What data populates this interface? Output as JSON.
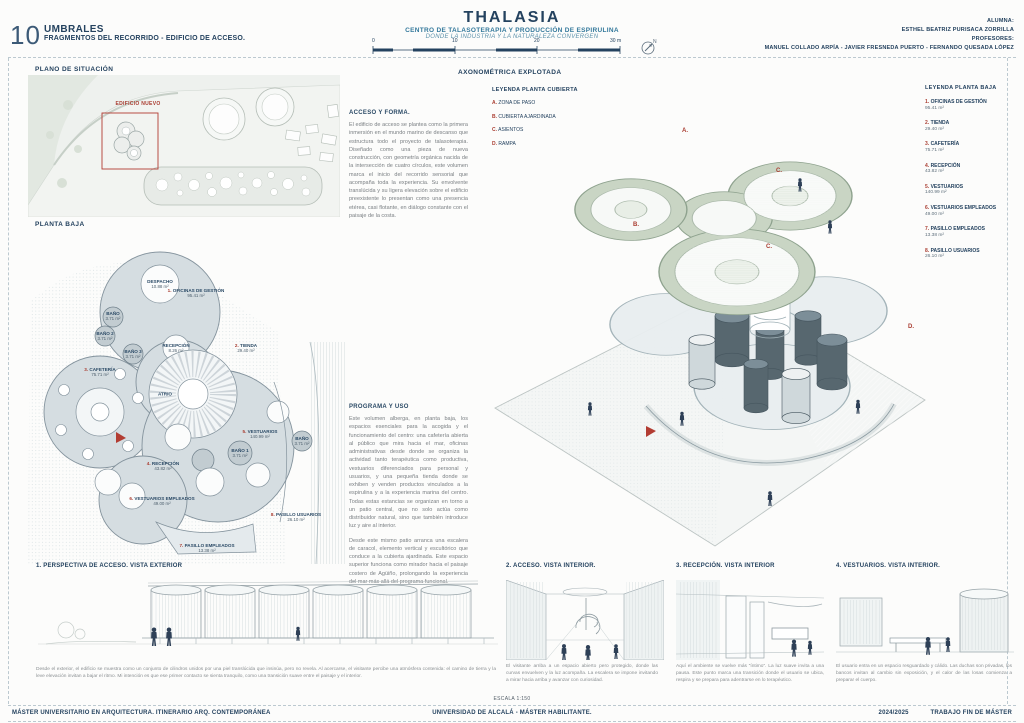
{
  "colors": {
    "navy": "#24425f",
    "red": "#a93c30",
    "teal": "#33789b",
    "roof_green": "#c9d5c4",
    "plan_gray": "#d5dde1"
  },
  "page": {
    "number": "10",
    "series_title": "UMBRALES",
    "series_subtitle": "FRAGMENTOS DEL RECORRIDO - EDIFICIO DE ACCESO.",
    "project_title": "THALASIA",
    "project_subtitle": "CENTRO DE TALASOTERAPIA Y PRODUCCIÓN DE ESPIRULINA",
    "project_tagline": "DONDE LA INDUSTRIA Y LA NATURALEZA CONVERGEN",
    "credits": {
      "alumna_label": "ALUMNA:",
      "alumna": "ESTHEL BEATRIZ PURISACA ZORRILLA",
      "profesores_label": "PROFESORES:",
      "profesores": "MANUEL COLLADO ARPÍA - JAVIER FRESNEDA PUERTO - FERNANDO QUESADA LÓPEZ"
    },
    "scale_bar": {
      "ticks": [
        "0",
        "10",
        "20",
        "30 m"
      ]
    },
    "escala": "ESCALA 1:150",
    "footer": {
      "left": "MÁSTER UNIVERSITARIO EN ARQUITECTURA. ITINERARIO ARQ. CONTEMPORÁNEA",
      "center": "UNIVERSIDAD DE ALCALÁ - MÁSTER HABILITANTE.",
      "right_year": "2024/2025",
      "right_title": "TRABAJO FIN DE MÁSTER"
    }
  },
  "situacion": {
    "title": "PLANO DE SITUACIÓN",
    "new_building_label": "EDIFICIO NUEVO"
  },
  "planta_baja": {
    "title": "PLANTA BAJA",
    "labels": [
      {
        "num": "",
        "name": "DESPACHO",
        "area": "10.88 m²"
      },
      {
        "num": "1.",
        "name": "OFICINAS DE GESTIÓN",
        "area": "95.41 m²"
      },
      {
        "num": "",
        "name": "RECEPCIÓN",
        "area": "8.26 m²"
      },
      {
        "num": "",
        "name": "BAÑO",
        "area": "3.71 m²"
      },
      {
        "num": "",
        "name": "BAÑO 2",
        "area": "3.71 m²"
      },
      {
        "num": "",
        "name": "BAÑO 3",
        "area": "3.71 m²"
      },
      {
        "num": "2.",
        "name": "TIENDA",
        "area": "29.40 m²"
      },
      {
        "num": "3.",
        "name": "CAFETERÍA",
        "area": "75.71 m²"
      },
      {
        "num": "",
        "name": "ATRIO",
        "area": ""
      },
      {
        "num": "4.",
        "name": "RECEPCIÓN",
        "area": "43.82 m²"
      },
      {
        "num": "5.",
        "name": "VESTUARIOS",
        "area": "140.99 m²"
      },
      {
        "num": "",
        "name": "BAÑO 1",
        "area": "3.71 m²"
      },
      {
        "num": "",
        "name": "BAÑO",
        "area": "3.71 m²"
      },
      {
        "num": "6.",
        "name": "VESTUARIOS EMPLEADOS",
        "area": "49.00 m²"
      },
      {
        "num": "7.",
        "name": "PASILLO EMPLEADOS",
        "area": "13.38 m²"
      },
      {
        "num": "8.",
        "name": "PASILLO USUARIOS",
        "area": "26.10 m²"
      }
    ]
  },
  "axonometrica": {
    "title": "AXONOMÉTRICA EXPLOTADA",
    "legend_title": "LEYENDA PLANTA CUBIERTA",
    "items": [
      {
        "key": "A.",
        "label": "ZONA DE PASO"
      },
      {
        "key": "B.",
        "label": "CUBIERTA AJARDINADA"
      },
      {
        "key": "C.",
        "label": "ASIENTOS"
      },
      {
        "key": "D.",
        "label": "RAMPA"
      }
    ],
    "roof_markers": [
      "A.",
      "C.",
      "B.",
      "C.",
      "D."
    ]
  },
  "leyenda_planta_baja": {
    "title": "LEYENDA PLANTA BAJA",
    "items": [
      {
        "num": "1.",
        "label": "OFICINAS DE GESTIÓN",
        "area": "95.41 m²"
      },
      {
        "num": "2.",
        "label": "TIENDA",
        "area": "29.40 m²"
      },
      {
        "num": "3.",
        "label": "CAFETERÍA",
        "area": "75.71 m²"
      },
      {
        "num": "4.",
        "label": "RECEPCIÓN",
        "area": "43.82 m²"
      },
      {
        "num": "5.",
        "label": "VESTUARIOS",
        "area": "140.99 m²"
      },
      {
        "num": "6.",
        "label": "VESTUARIOS EMPLEADOS",
        "area": "49.00 m²"
      },
      {
        "num": "7.",
        "label": "PASILLO EMPLEADOS",
        "area": "13.38 m²"
      },
      {
        "num": "8.",
        "label": "PASILLO USUARIOS",
        "area": "26.10 m²"
      }
    ]
  },
  "texts": {
    "acceso_title": "ACCESO Y FORMA.",
    "acceso_body": "El edificio de acceso se plantea como la primera inmersión en el mundo marino de descanso que estructura todo el proyecto de talasoterapia. Diseñado como una pieza de nueva construcción, con geometría orgánica nacida de la intersección de cuatro círculos, este volumen marca el inicio del recorrido sensorial que acompaña toda la experiencia. Su envolvente translúcida y su ligera elevación sobre el edificio preexistente lo presentan como una presencia etérea, casi flotante, en diálogo constante con el paisaje de la costa.",
    "programa_title": "PROGRAMA Y USO",
    "programa_body1": "Este volumen alberga, en planta baja, los espacios esenciales para la acogida y el funcionamiento del centro: una cafetería abierta al público que mira hacia el mar, oficinas administrativas desde donde se organiza la actividad tanto terapéutica como productiva, vestuarios diferenciados para personal y usuarios, y una pequeña tienda donde se exhiben y venden productos vinculados a la espirulina y a la experiencia marina del centro. Todas estas estancias se organizan en torno a un patio central, que no solo actúa como distribuidor natural, sino que también introduce luz y aire al interior.",
    "programa_body2": "Desde este mismo patio arranca una escalera de caracol, elemento vertical y escultórico que conduce a la cubierta ajardinada. Este espacio superior funciona como mirador hacia el paisaje costero de Agüiño, prolongando la experiencia del mar más allá del programa funcional."
  },
  "vistas": [
    {
      "title": "1. PERSPECTIVA DE ACCESO. VISTA EXTERIOR",
      "caption": "Desde el exterior, el edificio se muestra como un conjunto de cilindros unidos por una piel translúcida que insinúa, pero no revela. Al acercarse, el visitante percibe una atmósfera contenida: el camino de tierra y la leve elevación invitan a bajar el ritmo. Mi intención es que ese primer contacto se sienta tranquilo, como una transición suave entre el paisaje y el interior."
    },
    {
      "title": "2. ACCESO. VISTA INTERIOR.",
      "caption": "El visitante arriba a un espacio abierto pero protegido, donde las curvas envuelven y la luz acompaña. La escalera se impone invitando a mirar hacia arriba y avanzar con curiosidad."
    },
    {
      "title": "3. RECEPCIÓN. VISTA INTERIOR",
      "caption": "Aquí el ambiente se vuelve más “íntimo”. La luz suave invita a una pausa. Este punto marca una transición donde el usuario se ubica, respira y se prepara para adentrarse en lo terapéutico."
    },
    {
      "title": "4. VESTUARIOS. VISTA INTERIOR.",
      "caption": "El usuario entra en un espacio resguardado y cálido. Las duchas son privadas, los bancos invitan al cambio sin exposición, y el calor de las losas comienza a preparar el cuerpo."
    }
  ]
}
